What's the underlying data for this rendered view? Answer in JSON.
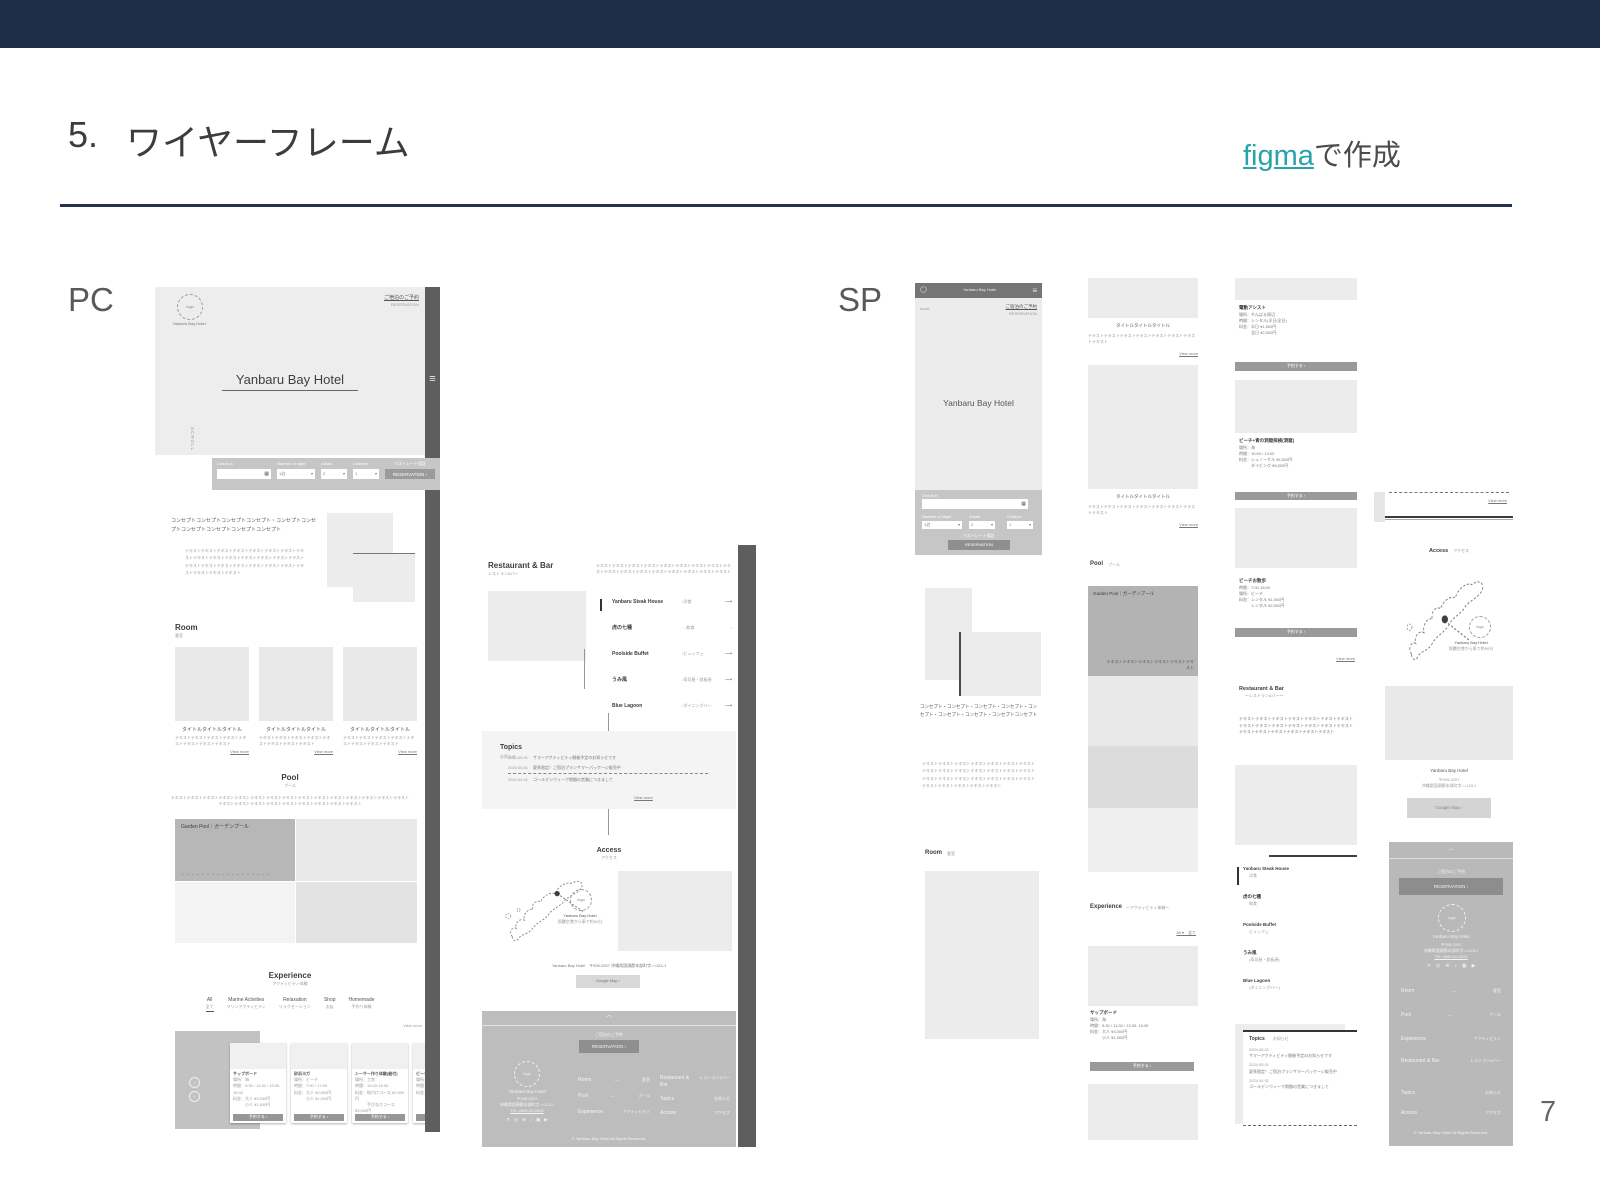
{
  "slide": {
    "title_number": "5.",
    "title": "ワイヤーフレーム",
    "credit_link": "figma",
    "credit_suffix": "で作成",
    "pc_label": "PC",
    "sp_label": "SP",
    "page_number": "7"
  },
  "colors": {
    "navy": "#1f2c4a",
    "teal": "#29a3ab",
    "strip_gray": "#5e5e5e"
  },
  "common": {
    "view_more": "View more"
  },
  "icons": {
    "hamburger": "≡",
    "chevron_up": "︿",
    "calendar": "▦",
    "caret": "▾",
    "arrow": "›",
    "arrow_long": "⟶",
    "prev": "‹",
    "next": "›",
    "dash": "—",
    "logo_mark": "◯"
  },
  "hotel": {
    "name": "Yanbaru Bay Hotel",
    "logo": "logo",
    "scroll": "SCROLL",
    "scroll_sp": "scroll"
  },
  "hero_links": {
    "l1": "ご宿泊のご予約",
    "l2": "RESERVATION"
  },
  "booking": {
    "checkin": "Check-in",
    "nights": "Number of night",
    "nights_sp": "Number of Night",
    "nights_v": "1泊",
    "adults": "Adults",
    "adults_v": "2",
    "children": "Children",
    "children_v": "1",
    "note": "ベストレート保証",
    "btn": "RESERVATION ›",
    "btn_sp": "RESERVATION"
  },
  "concept": {
    "t_pc": "コンセプトコンセプトコンセプトコンセプト・コンセプトコンセプトコンセプトコンセプトコンセプトコンセプト",
    "t_sp": "コンセプト・コンセプト・コンセプト・コンセプト・コンセプト・コンセプト・コンセプト・コンセプトコンセプト",
    "body": "テキストテキストテキストテキストテキストテキストテキストテキストテキストテキストテキストテキストテキストテキストテキストテキストテキストテキストテキストテキストテキストテキストテキストテキストテキストテキスト"
  },
  "room": {
    "en": "Room",
    "ja": "客室",
    "card_title": "タイトルタイトルタイトル",
    "card_text": "テキストテキストテキストテキストテキストテキストテキストテキスト"
  },
  "pool": {
    "en": "Pool",
    "ja": "プール",
    "lead": "テキストテキストテキストテキストテキストテキストテキストテキストテキストテキストテキストテキストテキストテキストテキストテキストテキストテキストテキストテキストテキストテキストテキストテキスト",
    "garden": "Garden Pool｜ガーデンプール",
    "garden_text": "テキストテキストテキストテキストテキストテキスト",
    "dots": "・・・・・・・・・・・・・・・・・・"
  },
  "experience": {
    "en": "Experience",
    "ja": "アクティビティ体験",
    "ja_sp": "～アクティビティ体験～",
    "filter": "All ▾　全て",
    "tabs": [
      {
        "en": "All",
        "ja": "全て"
      },
      {
        "en": "Marine Activities",
        "ja": "マリンアクティビティ"
      },
      {
        "en": "Relaxation",
        "ja": "リラクゼーション"
      },
      {
        "en": "Shop",
        "ja": "お店"
      },
      {
        "en": "Homemade",
        "ja": "手作り体験"
      }
    ],
    "pc_cards": [
      {
        "title": "サップボード",
        "l1": "場所：海",
        "l2": "時間：9:30 / 11:30 / 13:30, 15:30",
        "l3": "料金：大人 ¥3,000円",
        "l4": "　　　小人 ¥1,500円",
        "btn": "予約する ›"
      },
      {
        "title": "砂浜ヨガ",
        "l1": "場所：ビーチ",
        "l2": "時間：7:00 / 17:00",
        "l3": "料金：大人 ¥2,000円",
        "l4": "　　　小人 ¥1,000円",
        "btn": "予約する ›"
      },
      {
        "title": "シーサー作り体験(絵付)",
        "l1": "場所：工房",
        "l2": "時間：10:00-16:00",
        "l3": "料金：絵付けコース ¥2,500円",
        "l4": "　　　手びねりコース ¥3,500円",
        "btn": "予約する ›"
      },
      {
        "title": "ビーチサウナ",
        "l1": "場所：ビーチ",
        "l2": "時間：9:00-18:00",
        "l3": "料金：大人 ¥4,000円",
        "l4": "　　　小人 ¥2,000円",
        "btn": "予約する ›"
      }
    ],
    "sp_cards": [
      {
        "title": "電動アシスト",
        "l1": "場所：やんばる周辺",
        "l2": "時間：レンタル(半日/全日)",
        "l3": "料金：半日 ¥1,500円",
        "l4": "　　　全日 ¥2,500円",
        "btn": "予約する ›"
      },
      {
        "title": "ビーチ+青の洞窟探検(洞窟)",
        "l1": "場所：海",
        "l2": "時間：10:00 / 13:00",
        "l3": "料金：シュノーケル ¥4,500円",
        "l4": "　　　ダイビング ¥5,500円",
        "btn": "予約する ›"
      },
      {
        "title": "ビーチお散歩",
        "l1": "時間：7:00-18:00",
        "l2": "場所：ビーチ",
        "l3": "料金：レンタル ¥1,500円",
        "l4": "　　　レンタル ¥2,500円",
        "btn": "予約する ›"
      }
    ]
  },
  "restaurant": {
    "en": "Restaurant & Bar",
    "ja": "レストラン&バー",
    "ja_sp": "～レストラン&バー～",
    "lead": "テキストテキストテキストテキストテキストテキストテキストテキストテキストテキストテキストテキストテキストテキストテキストテキストテキストテキストテキストテキスト",
    "items": [
      {
        "name": "Yanbaru Steak House",
        "cat": "/洋食",
        "cat_sp": "洋食"
      },
      {
        "name": "虎の七種",
        "cat": "/和食",
        "cat_sp": "和食"
      },
      {
        "name": "Poolside Buffet",
        "cat": "/ビュッフェ",
        "cat_sp": "ビュッフェ"
      },
      {
        "name": "うみ風",
        "cat": "/寿司屋・鉄板焼",
        "cat_sp": "(寿司屋・鉄板焼)"
      },
      {
        "name": "Blue Lagoon",
        "cat": "/ダイニングバー",
        "cat_sp": "(ダイニングバー)"
      }
    ]
  },
  "topics": {
    "en": "Topics",
    "ja": "お知らせ",
    "items": [
      {
        "date": "2024.05.01",
        "text": "サマーアクティビティ開催予定のお知らせです"
      },
      {
        "date": "2024.05.01",
        "text": "夏季限定！ご宿泊プランサマーパッケージ販売中"
      },
      {
        "date": "2024.04.01",
        "text": "ゴールデンウィーク期間の営業につきまして"
      }
    ]
  },
  "access": {
    "en": "Access",
    "ja": "アクセス",
    "map_name": "Yanbaru Bay Hotel",
    "map_note": "那覇空港から車で約90分",
    "addr_pc": "Yanbaru Bay Hotel　〒905-0207 沖縄県国頭郡本部町字○○123-1",
    "btn": "Google Map ›"
  },
  "footer": {
    "note": "ご宿泊のご予約",
    "btn": "RESERVATION ›",
    "name": "Yanbaru Bay Hotel",
    "postal": "〒905-0207",
    "addr": "沖縄県国頭郡本部町字○○123-1",
    "tel": "TEL.0980-00-0000",
    "nav": [
      {
        "en": "Room",
        "ja": "客室"
      },
      {
        "en": "Pool",
        "ja": "プール"
      },
      {
        "en": "Experience",
        "ja": "アクティビティ"
      },
      {
        "en": "Restaurant & Bar",
        "ja": "レストラン&バー"
      },
      {
        "en": "Topics",
        "ja": "お知らせ"
      },
      {
        "en": "Access",
        "ja": "アクセス"
      }
    ],
    "socials": [
      "✕",
      "◎",
      "⊕",
      "♪",
      "▣",
      "▶"
    ],
    "copyright": "© Yanbaru Bay Hotel All Rights Reserved."
  }
}
